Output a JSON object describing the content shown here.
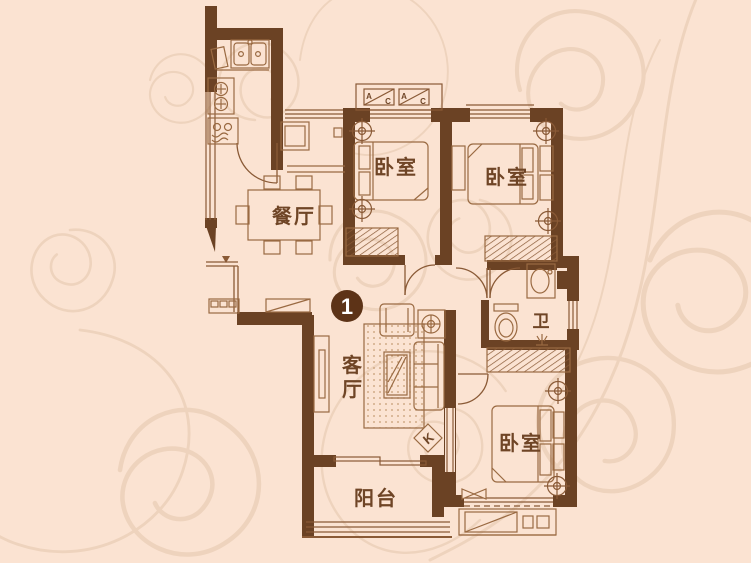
{
  "plan": {
    "unit_badge": "1",
    "labels": {
      "dining": "餐厅",
      "living_vertical": [
        "客",
        "厅"
      ],
      "bedroom_top": "卧室",
      "bedroom_right": "卧室",
      "bedroom_bottom": "卧室",
      "bathroom": "卫",
      "balcony": "阳台"
    },
    "markers": {
      "ac_a": "A",
      "ac_c": "C",
      "k": "K"
    },
    "colors": {
      "background": "#fbe3d2",
      "wall": "#6b4224",
      "line": "#8a5a36",
      "label": "#6f4526",
      "badge": "#5d3317",
      "swirl": "#eed3bd"
    }
  }
}
